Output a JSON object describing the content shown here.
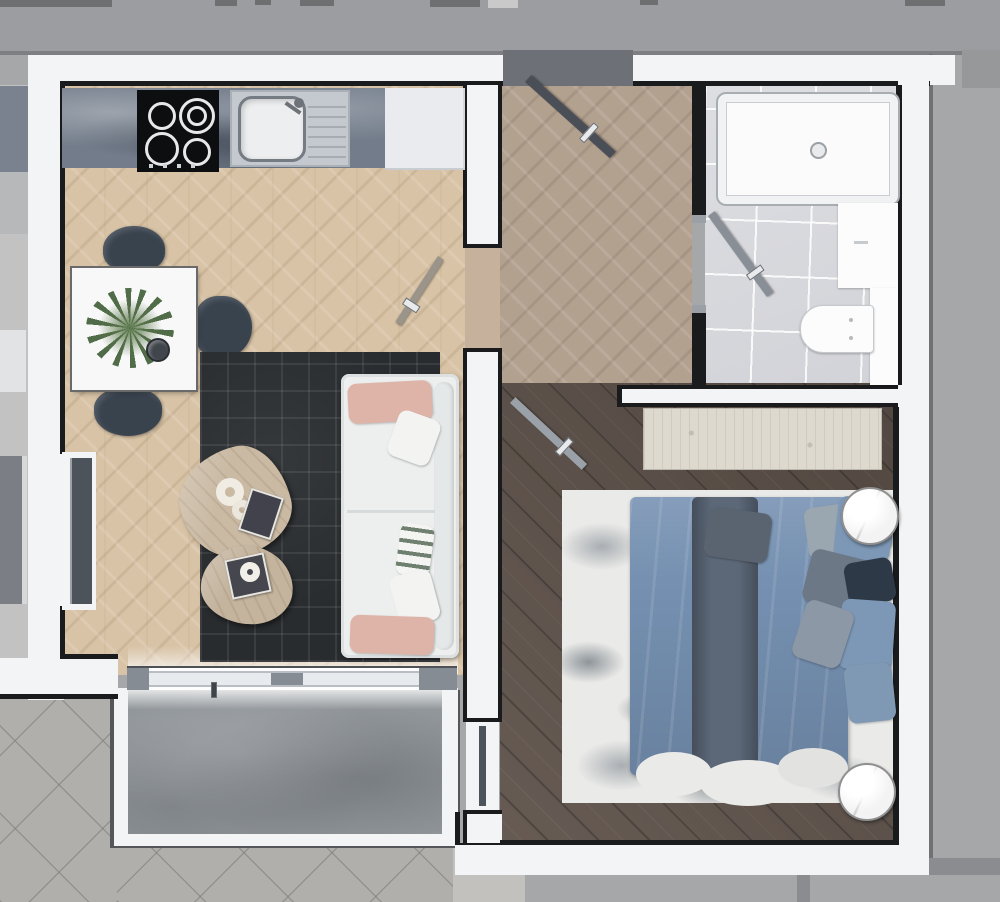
{
  "palette": {
    "concrete": "#a6a7a9",
    "topStrip": "#9c9da0",
    "topLine": "#7e7f82",
    "fragment": "#6e6f71",
    "pavement": "#b1afac",
    "pavementLight": "#c3c1be",
    "wall": "#f3f4f5",
    "black": "#1a1b1d",
    "edgeDark": "#54565a",
    "parquetKitchen": "#d8c3a6",
    "parquetHall": "#b3a190",
    "parquetDoor": "#c6b29c",
    "woodFloor": "#5d5149",
    "tile": "#d9dade",
    "balcony": "#91969a",
    "glass": "#e8ebee",
    "glassFrame": "#868c94",
    "threshold": "#6d7177",
    "doorLeaf": "#4a4f57",
    "doorLeafLight": "#9aa1a8",
    "counter": "#727c8a",
    "steel": "#c3c9cf",
    "steelDark": "#757b82",
    "stove": "#0d0e10",
    "cabinet": "#e9ebee",
    "tableWhite": "#f8f8f8",
    "chair": "#39434e",
    "plant": "#5b7a52",
    "rugDark": "#292c2f",
    "sofa": "#edefef",
    "blush": "#dfb4a8",
    "pillowWhite": "#f3f3f2",
    "stripeGreen": "#6f8070",
    "woodTable": "#cabaa4",
    "magazine": "#41424b",
    "console": "#ded9ce",
    "bedRug": "#eaeae8",
    "splotchGray": "#a9aeb2",
    "duvet": "#7590b1",
    "runner": "#5c6878",
    "pillowBlue": "#7d98b6",
    "pillowGray": "#9aa6b0",
    "pillowSlate": "#6c7886",
    "pillowNavy": "#2e3947",
    "marbleTable": "#f3f3f3",
    "windowGlass": "#4d535b",
    "neighbor": "#c2c2c3",
    "bandGray": "#8b8c8f",
    "cornerBlock": "#96989a"
  },
  "scene": {
    "type": "apartment-floor-plan-render",
    "rooms": [
      "kitchen-living-room",
      "hallway",
      "bathroom",
      "bedroom",
      "balcony"
    ],
    "kitchen": [
      "marble-countertop",
      "cooktop-4-burners",
      "sink-with-drainboard",
      "white-cabinet"
    ],
    "dining": [
      "square-white-table",
      "potted-plant",
      "cup",
      "chair",
      "chair",
      "chair"
    ],
    "living": [
      "dark-area-rug",
      "white-sofa",
      "blush-pillow",
      "white-pillow",
      "striped-pillow",
      "white-pillow",
      "blush-pillow",
      "coffee-table",
      "coffee-table",
      "magazines",
      "decor-rings"
    ],
    "hallway": [
      "entrance-door-open",
      "interior-door-open"
    ],
    "bathroom": [
      "bathtub",
      "vanity-cabinet",
      "wall-hung-toilet",
      "side-ledge",
      "door-open"
    ],
    "bedroom": [
      "wood-console",
      "double-bed-blue-duvet",
      "pillows",
      "patterned-area-rug",
      "round-side-table",
      "round-side-table",
      "window",
      "door-open"
    ],
    "balcony": [
      "concrete-floor",
      "white-railing",
      "sliding-glass-door"
    ],
    "exterior": [
      "concrete-walkway",
      "diagonal-paved-plaza",
      "neighbor-unit-sliver"
    ]
  }
}
